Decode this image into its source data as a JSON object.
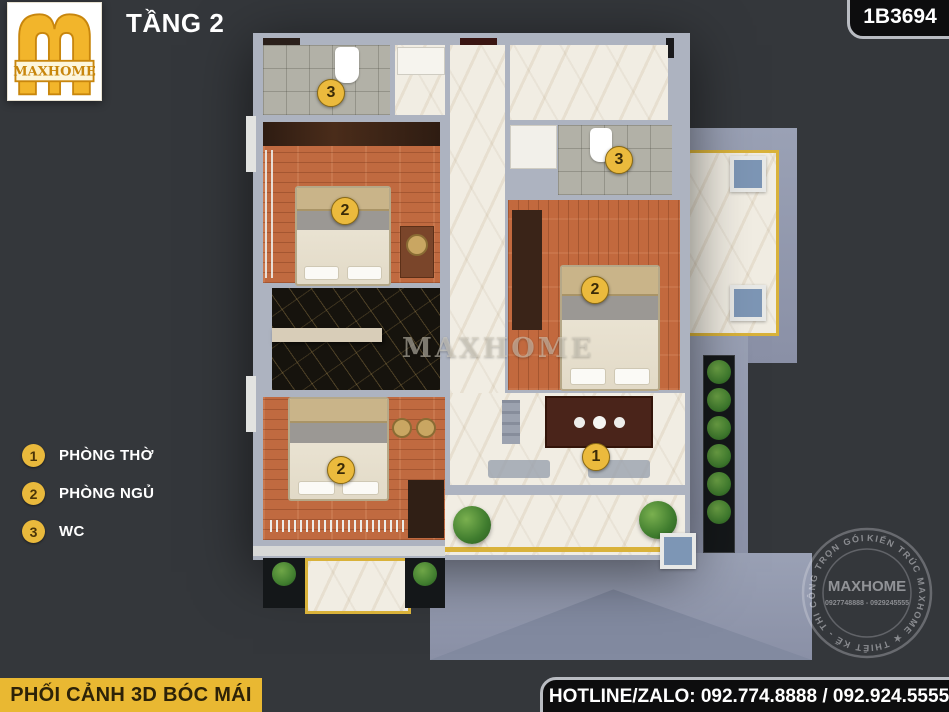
{
  "header": {
    "floor_label": "TẦNG 2",
    "drawing_code": "1B3694"
  },
  "logo": {
    "brand": "MAXHOME"
  },
  "legend": {
    "items": [
      {
        "num": "1",
        "label": "PHÒNG THỜ"
      },
      {
        "num": "2",
        "label": "PHÒNG NGỦ"
      },
      {
        "num": "3",
        "label": "WC"
      }
    ]
  },
  "plan": {
    "markers": [
      {
        "id": "wc-top",
        "label": "3"
      },
      {
        "id": "wc-right",
        "label": "3"
      },
      {
        "id": "bedroom-top-left",
        "label": "2"
      },
      {
        "id": "bedroom-right",
        "label": "2"
      },
      {
        "id": "bedroom-bottom-left",
        "label": "2"
      },
      {
        "id": "altar",
        "label": "1"
      }
    ],
    "watermark": "MAXHOME"
  },
  "stamp": {
    "ring_text": "KIẾN TRÚC MAXHOME ★ THIẾT KẾ - THI CÔNG TRỌN GÓI ★",
    "brand": "MAXHOME",
    "phones": "0927748888 - 0929245555"
  },
  "footer": {
    "view_label": "PHỐI CẢNH 3D BÓC MÁI",
    "hotline": "HOTLINE/ZALO: 092.774.8888 / 092.924.5555"
  },
  "colors": {
    "background": "#34373B",
    "accent_yellow": "#E9B832",
    "marker_yellow": "#EBBA3D",
    "wall_gray": "#ADB3C0",
    "wood": "#C06A40",
    "marble": "#F1EDE3",
    "black_marble": "#16130D",
    "roof": "#9AA1B5",
    "box_black": "#0D0D0E",
    "border_silver": "#B9BCC2",
    "skylight_blue": "#7D96B5",
    "plant_green": "#3F7C2E"
  }
}
